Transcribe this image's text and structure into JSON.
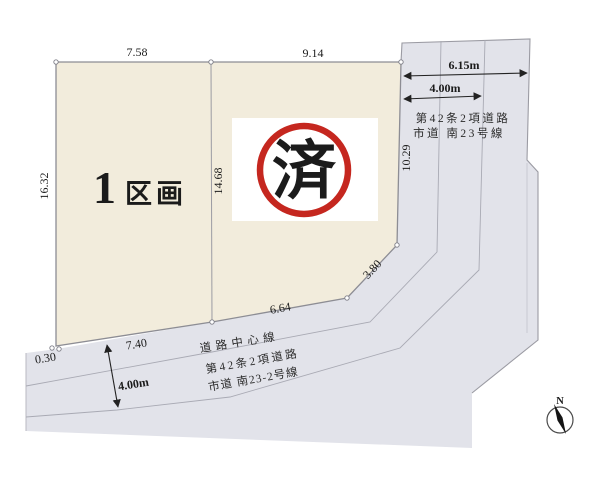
{
  "colors": {
    "parcel_fill": "#f2ecdc",
    "road_fill": "#e2e3ea",
    "outline": "#94949c",
    "stamp_red": "#c5271f",
    "parcel_label": "#20395c",
    "dim_text": "#1b1b1b"
  },
  "parcel": {
    "number": "1",
    "unit_label": "区画",
    "dim_top_left": "7.58",
    "dim_top_right": "9.14",
    "dim_left": "16.32",
    "dim_center": "14.68",
    "dim_right": "10.29",
    "dim_corner_cut": "3.80",
    "dim_bottom_right": "6.64",
    "dim_bottom_left": "7.40",
    "dim_offset": "0.30"
  },
  "stamp": {
    "label": "済"
  },
  "road_east": {
    "total_width": "6.15m",
    "lane_width": "4.00m",
    "name_line1": "第42条2項道路",
    "name_line2": "市道 南23号線"
  },
  "road_south": {
    "center_line_label": "道路中心線",
    "name_line1": "第42条2項道路",
    "name_line2": "市道 南23-2号線",
    "width": "4.00m"
  },
  "compass": {
    "north_label": "N"
  }
}
